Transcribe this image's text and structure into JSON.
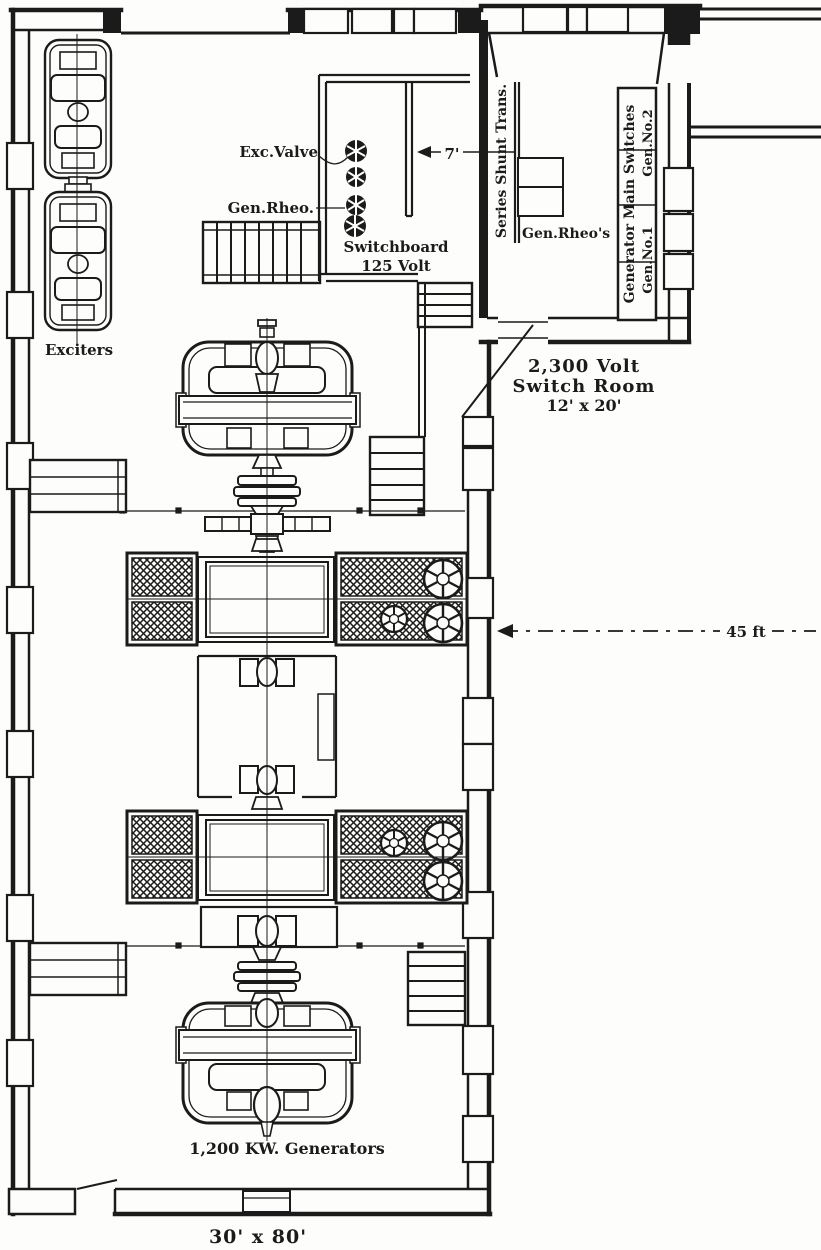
{
  "figure": {
    "type": "power-station-floor-plan",
    "ink_color": "#1b1b1b",
    "paper_color": "#fdfdfb"
  },
  "labels": {
    "exc_valve": "Exc.Valve",
    "gen_rheo": "Gen.Rheo.",
    "switchboard_line1": "Switchboard",
    "switchboard_line2": "125 Volt",
    "series_shunt_trans": "Series Shunt Trans.",
    "gen_rheos": "Gen.Rheo's",
    "generator_main_switches": "Generator Main Switches",
    "gen_no1": "Gen.No.1",
    "gen_no2": "Gen.No.2",
    "switch_room_line1": "2,300 Volt",
    "switch_room_line2": "Switch Room",
    "switch_room_line3": "12' x 20'",
    "exciters": "Exciters",
    "generators_label": "1,200 KW. Generators",
    "room_size": "30' x 80'",
    "dim_7ft": "7'",
    "dim_45ft": "45 ft"
  }
}
